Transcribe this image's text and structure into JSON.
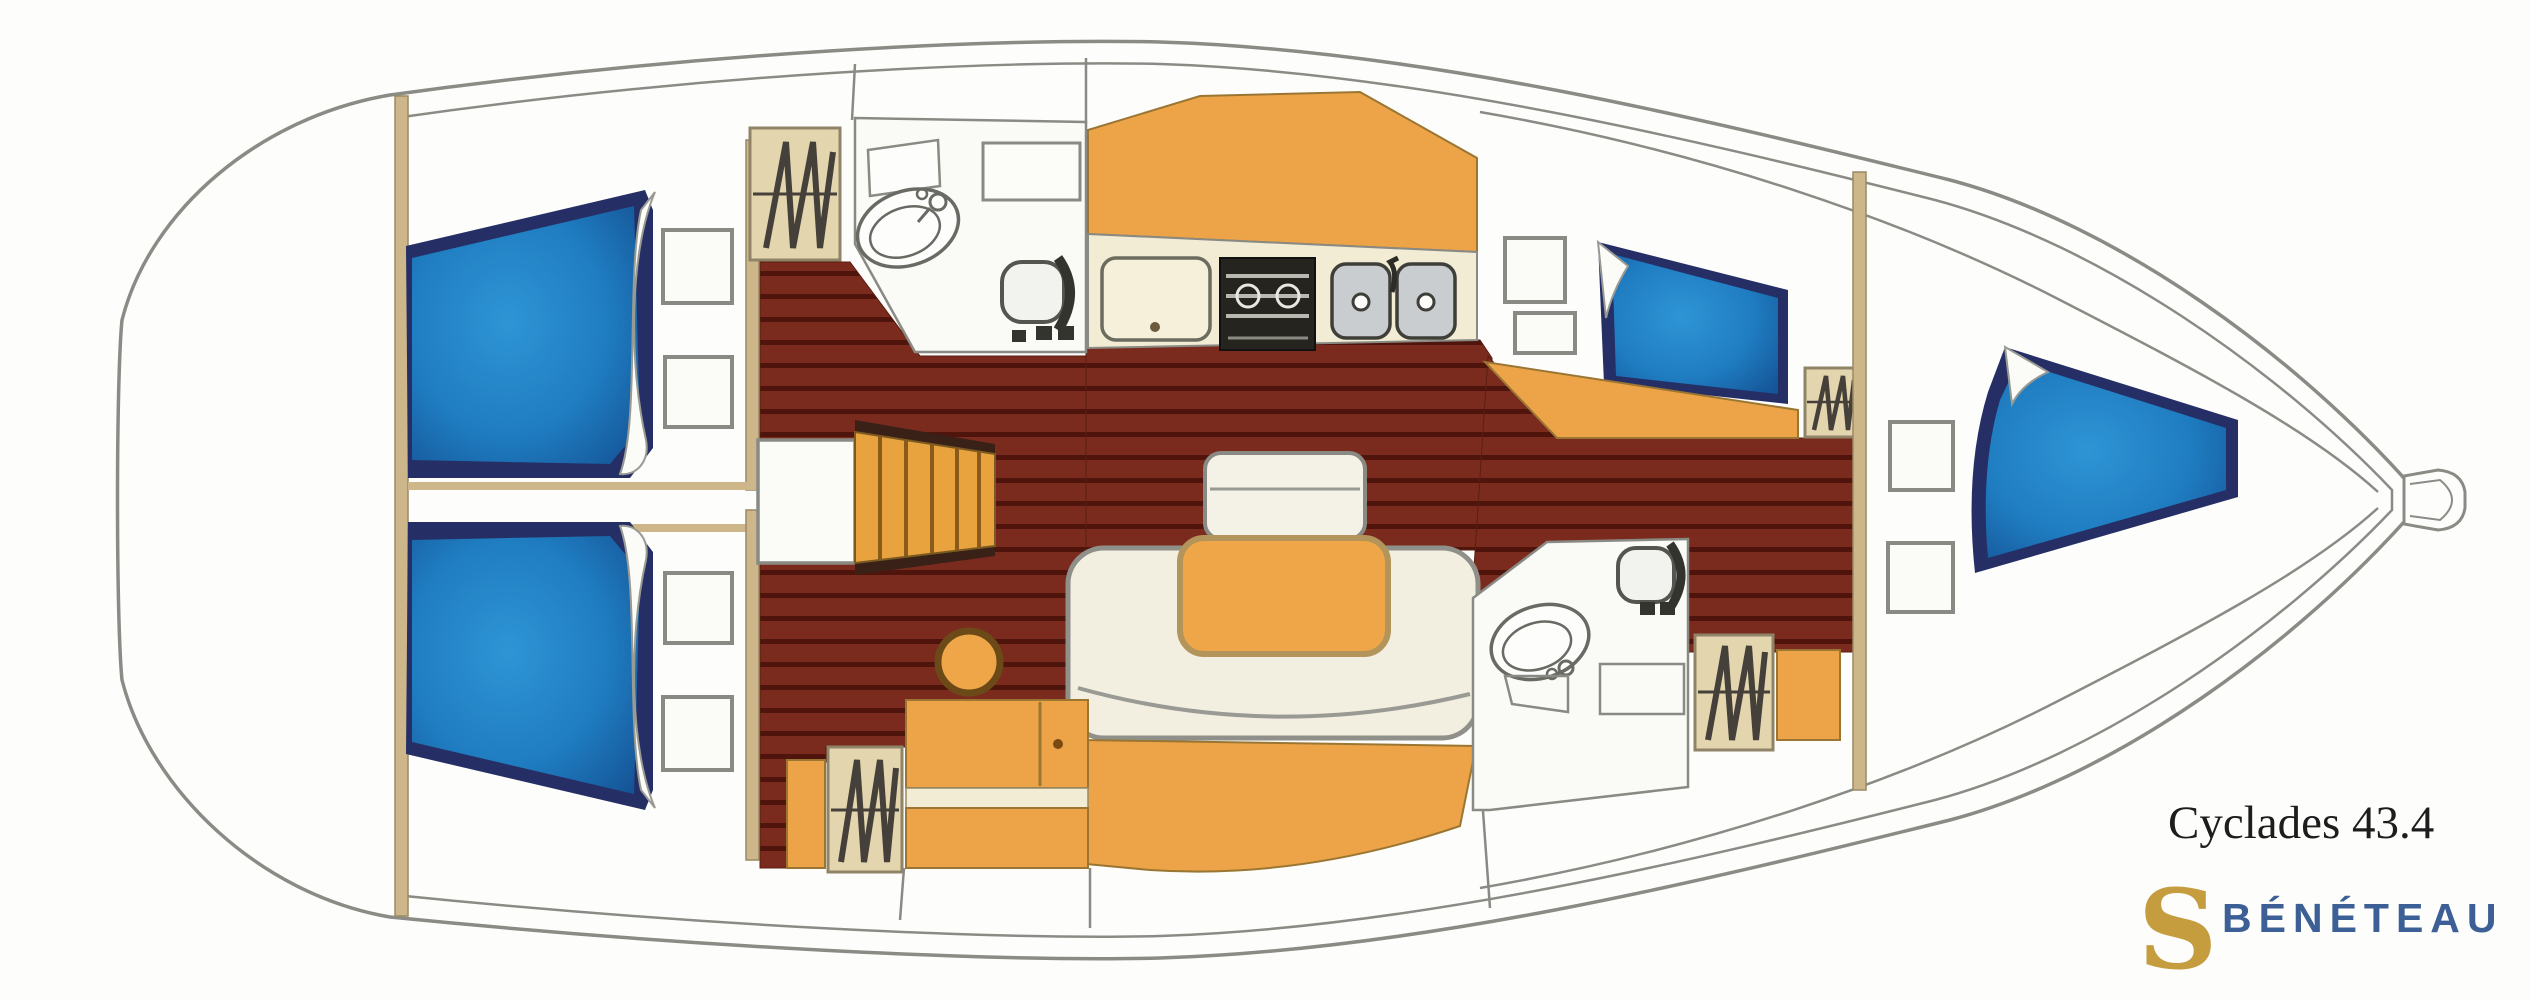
{
  "header": {
    "model_name": "Cyclades 43.4",
    "brand_name": "BÉNÉTEAU",
    "brand_logo_letter": "S"
  },
  "theme": {
    "paper": "#fdfdfc",
    "hull-line": "#8b8b85",
    "mattress-blue": "#1f7cc0",
    "mattress-navy": "#252f66",
    "wood-floor": "#7b2b1e",
    "wood-plank-line": "#4f150c",
    "furniture-orange": "#eda449",
    "table-orange": "#efa648",
    "bulkhead-tan": "#cdb68a",
    "locker-tan": "#e3d6ae",
    "counter-cream": "#f2ecd4",
    "settee-cream": "#f2eee0",
    "stove-black": "#26241f",
    "sink-gray": "#c9cdcf",
    "brand-blue": "#3c5f95",
    "logo-gold": "#c59c3e"
  }
}
